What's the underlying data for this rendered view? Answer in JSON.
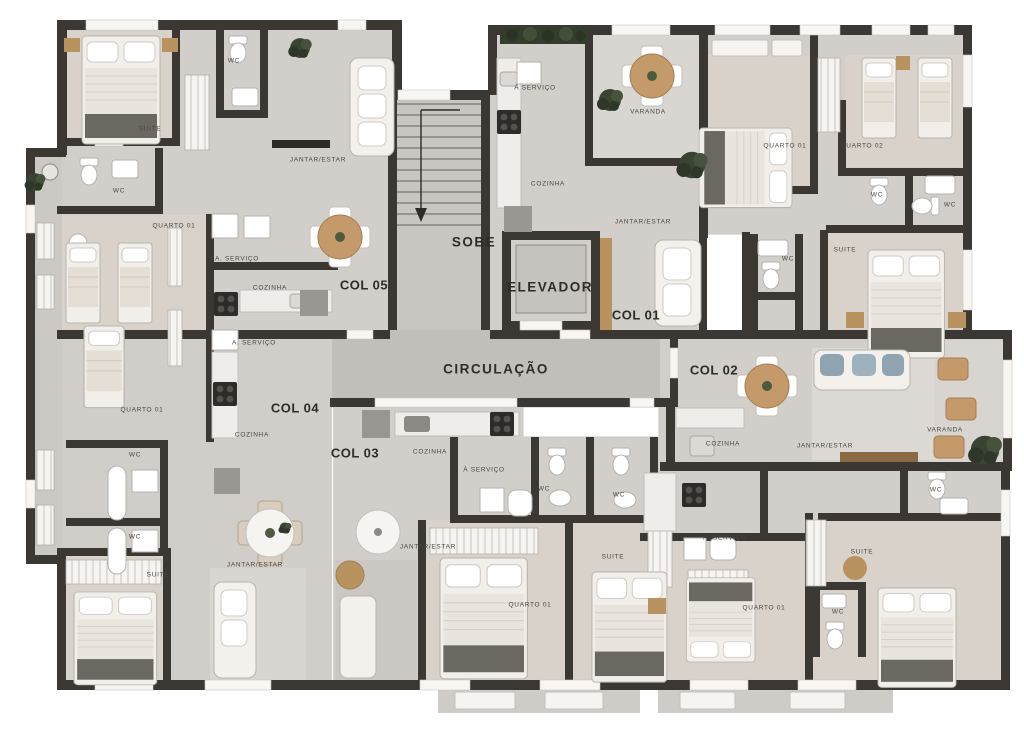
{
  "plan": {
    "type": "residential-floor-plan",
    "core_labels": [
      "SOBE",
      "ELEVADOR",
      "CIRCULAÇÃO"
    ],
    "unit_labels": [
      "COL 01",
      "COL 02",
      "COL 03",
      "COL 04",
      "COL 05"
    ],
    "labels": [
      {
        "text": "SOBE",
        "x": 474,
        "y": 242,
        "kind": "core"
      },
      {
        "text": "ELEVADOR",
        "x": 550,
        "y": 287,
        "kind": "core"
      },
      {
        "text": "CIRCULAÇÃO",
        "x": 496,
        "y": 369,
        "kind": "core"
      },
      {
        "text": "COL 01",
        "x": 636,
        "y": 315,
        "kind": "col"
      },
      {
        "text": "COL 02",
        "x": 714,
        "y": 370,
        "kind": "col"
      },
      {
        "text": "COL 03",
        "x": 355,
        "y": 453,
        "kind": "col"
      },
      {
        "text": "COL 04",
        "x": 295,
        "y": 408,
        "kind": "col"
      },
      {
        "text": "COL 05",
        "x": 364,
        "y": 285,
        "kind": "col"
      },
      {
        "text": "SUITE",
        "x": 150,
        "y": 129,
        "kind": "room"
      },
      {
        "text": "WC",
        "x": 234,
        "y": 61,
        "kind": "room"
      },
      {
        "text": "WC",
        "x": 119,
        "y": 191,
        "kind": "room"
      },
      {
        "text": "QUARTO 01",
        "x": 174,
        "y": 226,
        "kind": "room"
      },
      {
        "text": "JANTAR/ESTAR",
        "x": 318,
        "y": 160,
        "kind": "room"
      },
      {
        "text": "A. SERVIÇO",
        "x": 237,
        "y": 259,
        "kind": "room"
      },
      {
        "text": "COZINHA",
        "x": 270,
        "y": 288,
        "kind": "room"
      },
      {
        "text": "À SERVIÇO",
        "x": 535,
        "y": 88,
        "kind": "room"
      },
      {
        "text": "COZINHA",
        "x": 548,
        "y": 184,
        "kind": "room"
      },
      {
        "text": "VARANDA",
        "x": 648,
        "y": 112,
        "kind": "room"
      },
      {
        "text": "JANTAR/ESTAR",
        "x": 643,
        "y": 222,
        "kind": "room"
      },
      {
        "text": "QUARTO 01",
        "x": 785,
        "y": 146,
        "kind": "room"
      },
      {
        "text": "QUARTO 02",
        "x": 862,
        "y": 146,
        "kind": "room"
      },
      {
        "text": "WC",
        "x": 877,
        "y": 195,
        "kind": "room"
      },
      {
        "text": "WC",
        "x": 950,
        "y": 205,
        "kind": "room"
      },
      {
        "text": "SUITE",
        "x": 845,
        "y": 250,
        "kind": "room"
      },
      {
        "text": "WC",
        "x": 788,
        "y": 259,
        "kind": "room"
      },
      {
        "text": "A. SERVIÇO",
        "x": 254,
        "y": 343,
        "kind": "room"
      },
      {
        "text": "QUARTO 01",
        "x": 142,
        "y": 410,
        "kind": "room"
      },
      {
        "text": "COZINHA",
        "x": 252,
        "y": 435,
        "kind": "room"
      },
      {
        "text": "WC",
        "x": 135,
        "y": 455,
        "kind": "room"
      },
      {
        "text": "WC",
        "x": 135,
        "y": 537,
        "kind": "room"
      },
      {
        "text": "SUITE",
        "x": 158,
        "y": 575,
        "kind": "room"
      },
      {
        "text": "JANTAR/ESTAR",
        "x": 255,
        "y": 565,
        "kind": "room"
      },
      {
        "text": "COZINHA",
        "x": 430,
        "y": 452,
        "kind": "room"
      },
      {
        "text": "À SERVIÇO",
        "x": 484,
        "y": 470,
        "kind": "room"
      },
      {
        "text": "WC",
        "x": 544,
        "y": 489,
        "kind": "room"
      },
      {
        "text": "WC",
        "x": 619,
        "y": 495,
        "kind": "room"
      },
      {
        "text": "JANTAR/ESTAR",
        "x": 428,
        "y": 547,
        "kind": "room"
      },
      {
        "text": "SUITE",
        "x": 613,
        "y": 557,
        "kind": "room"
      },
      {
        "text": "QUARTO 01",
        "x": 530,
        "y": 605,
        "kind": "room"
      },
      {
        "text": "COZINHA",
        "x": 723,
        "y": 444,
        "kind": "room"
      },
      {
        "text": "JANTAR/ESTAR",
        "x": 825,
        "y": 446,
        "kind": "room"
      },
      {
        "text": "WC",
        "x": 936,
        "y": 490,
        "kind": "room"
      },
      {
        "text": "A. SERVIÇO",
        "x": 725,
        "y": 538,
        "kind": "room"
      },
      {
        "text": "SUITE",
        "x": 862,
        "y": 552,
        "kind": "room"
      },
      {
        "text": "QUARTO 01",
        "x": 764,
        "y": 608,
        "kind": "room"
      },
      {
        "text": "WC",
        "x": 838,
        "y": 612,
        "kind": "room"
      },
      {
        "text": "VARANDA",
        "x": 945,
        "y": 430,
        "kind": "room"
      }
    ],
    "colors": {
      "wall": "#3b3733",
      "floor": "#d2cec9",
      "floor_dark": "#c5c2be",
      "floor_warm": "#d8d2ca",
      "white": "#f8f6f3",
      "wood": "#b9935f",
      "plant_green": "#3a4433",
      "cushion_blue": "#8fa3b0"
    }
  }
}
